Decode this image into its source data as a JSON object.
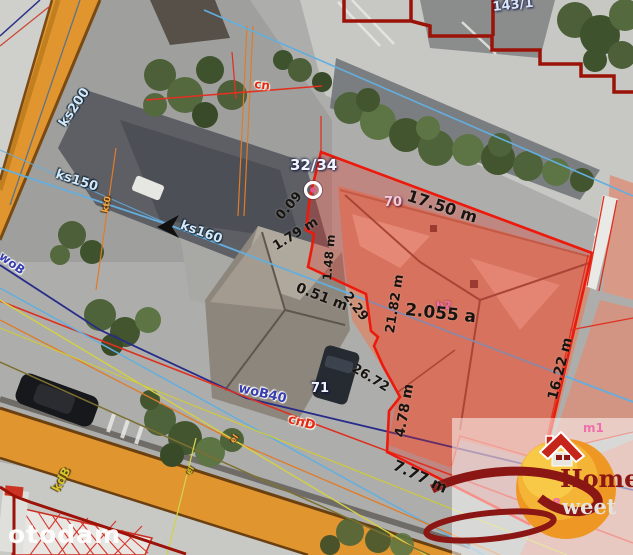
{
  "watermark": {
    "brand": "otodam"
  },
  "parcel_labels": {
    "subject": "32/34",
    "top_neighbor": "143/1"
  },
  "building_numbers": {
    "house_a": "70",
    "house_b": "71"
  },
  "building_annotations": {
    "b2": "b2",
    "m1": "m1",
    "b18": "18"
  },
  "area_label": "2.055 a",
  "dimensions": {
    "top_edge": "17.50 m",
    "right_edge": "16.22 m",
    "side_edge": "4.78 m",
    "bottom_edge": "7.77 m",
    "step_a": "0.09",
    "step_b": "1.79 m",
    "step_c": "1.48 m",
    "step_d": "0.51 m",
    "step_e": "21.82 m",
    "step_f": "2.29",
    "step_g": "26.72"
  },
  "utility_labels": {
    "ks200": "ks200",
    "ks150": "ks150",
    "ks160": "ks160",
    "kt0": "kt0",
    "cn": "cn",
    "wob": "woB",
    "wob40": "woB40",
    "cnd": "cnD",
    "kdb": "kdB",
    "el_a": "el",
    "el_b": "el"
  },
  "logo": {
    "word1": "Home",
    "word2": "weet",
    "number": "18"
  },
  "colors": {
    "parcel_boundary_red": "#ec1a0c",
    "cadastral_dark_red": "#9a1208",
    "road_orange": "#e0952e",
    "line_blue": "#63aede",
    "line_navy": "#272c88",
    "line_yellow": "#d6cf45",
    "line_orange": "#e07b28",
    "label_pink": "#f06eac",
    "logo_dark_red": "#8a1714",
    "logo_sun_orange": "#ee9724"
  }
}
